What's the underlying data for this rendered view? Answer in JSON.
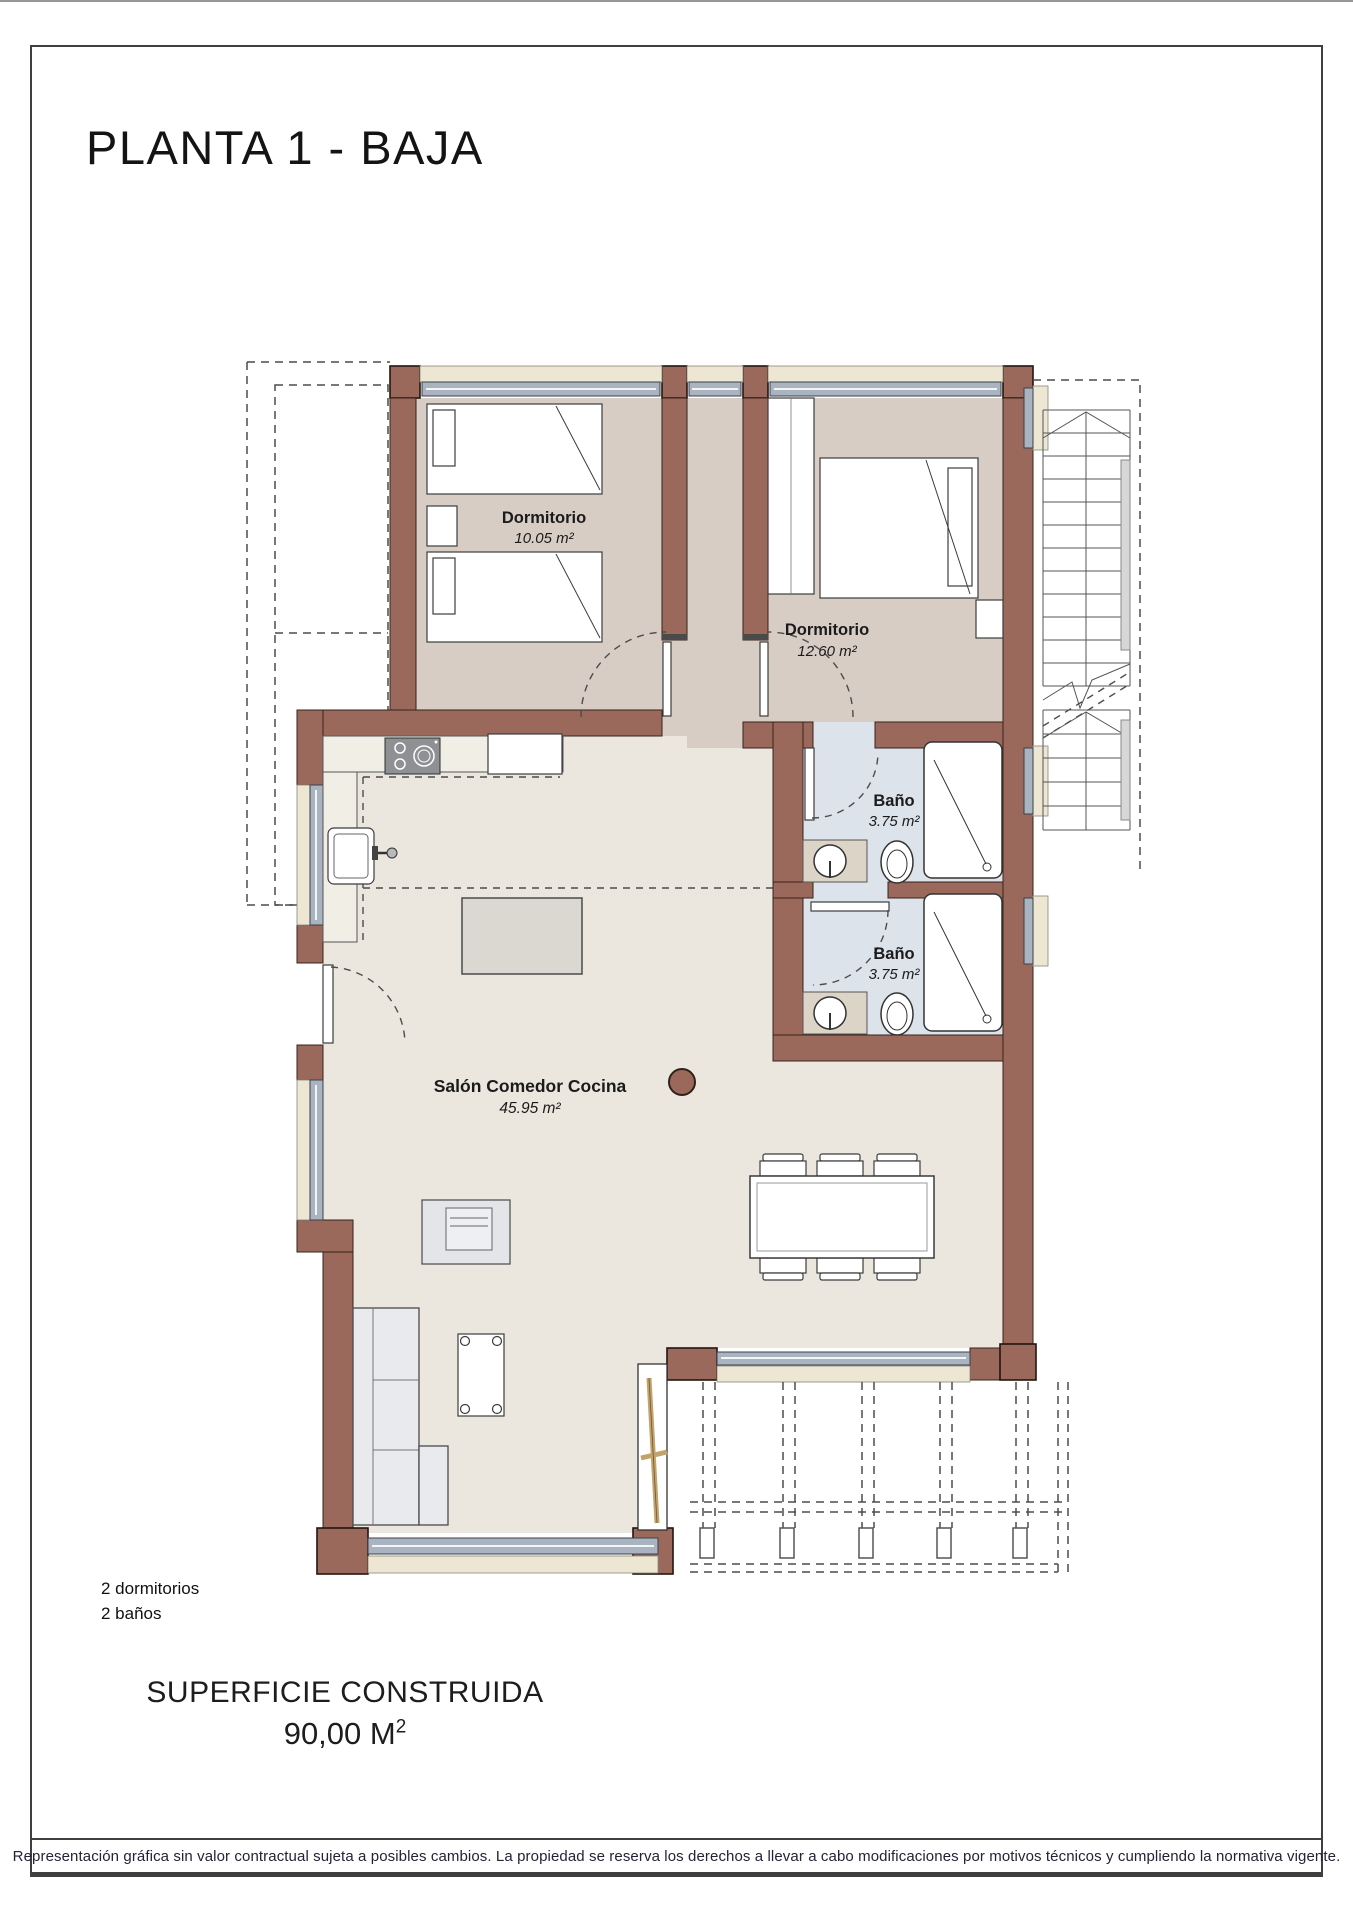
{
  "title": "PLANTA 1 - BAJA",
  "rooms": {
    "dormitorio1": {
      "name": "Dormitorio",
      "area": "10.05 m²"
    },
    "dormitorio2": {
      "name": "Dormitorio",
      "area": "12.60 m²"
    },
    "bano1": {
      "name": "Baño",
      "area": "3.75 m²"
    },
    "bano2": {
      "name": "Baño",
      "area": "3.75 m²"
    },
    "salon": {
      "name": "Salón Comedor Cocina",
      "area": "45.95 m²"
    }
  },
  "summary": {
    "bedrooms": "2 dormitorios",
    "bathrooms": "2 baños"
  },
  "surface": {
    "label": "SUPERFICIE CONSTRUIDA",
    "value": "90,00 M",
    "sup": "2"
  },
  "footer": {
    "disclaimer": "Representación gráfica sin valor contractual sujeta a posibles cambios. La propiedad se reserva los derechos a llevar a cabo modificaciones por motivos técnicos y cumpliendo la normativa vigente."
  },
  "colors": {
    "wall": "#9a695b",
    "bedroom_floor": "#d8cdc5",
    "bathroom_floor": "#dde3eb",
    "living_floor": "#ebe7de",
    "window_sill": "#ece6d3",
    "glazing": "#aab3c0"
  }
}
